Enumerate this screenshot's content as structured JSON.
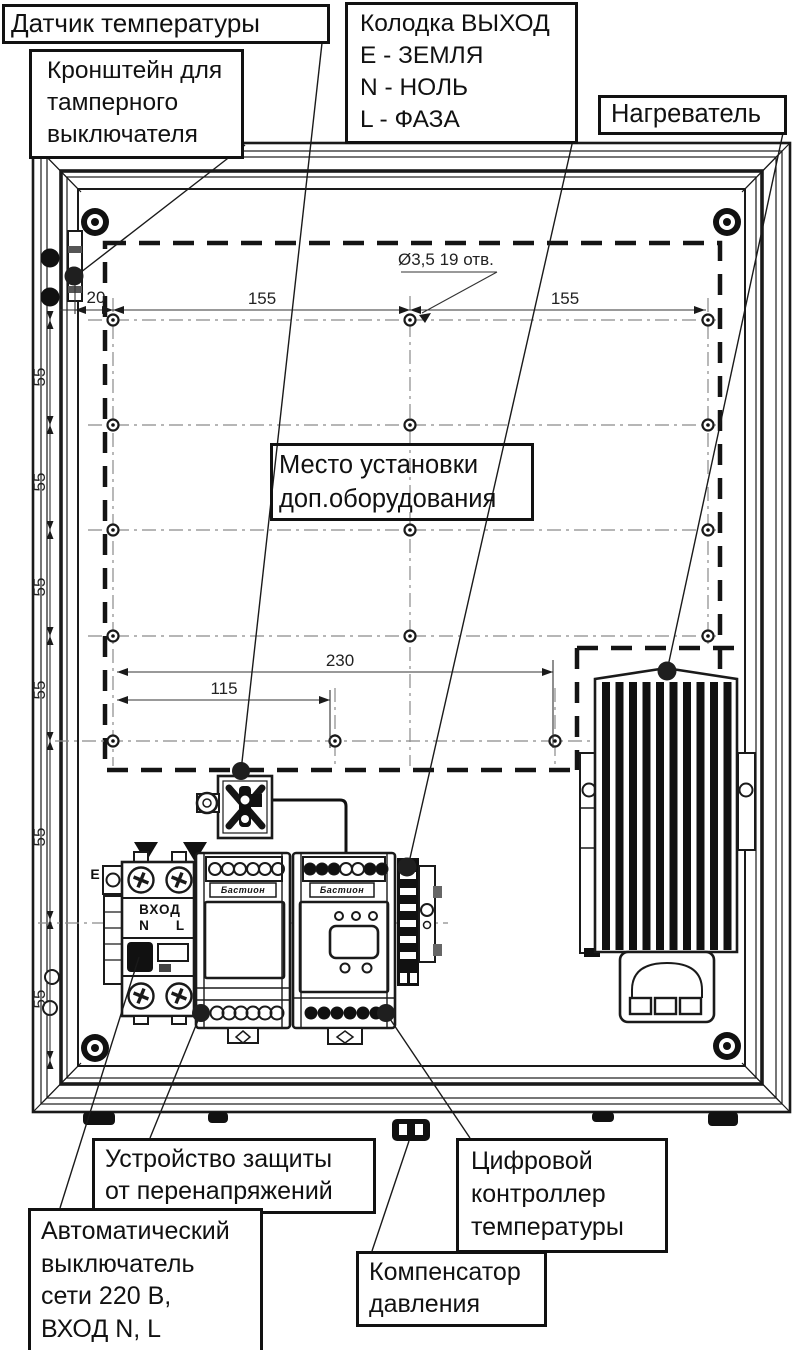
{
  "drawing": {
    "title": "Схема внутреннего монтажа шкафа (вид спереди)",
    "callouts": {
      "temp_sensor": {
        "text": "Датчик температуры"
      },
      "tamper_bracket": {
        "text": "Кронштейн для\nтамперного\nвыключателя"
      },
      "output_block": {
        "text": "Колодка ВЫХОД\nE - ЗЕМЛЯ\nN - НОЛЬ\nL - ФАЗА"
      },
      "heater": {
        "text": "Нагреватель"
      },
      "equipment_area": {
        "text": "Место установки\nдоп.оборудования"
      },
      "surge_protector": {
        "text": "Устройство защиты\nот перенапряжений"
      },
      "breaker": {
        "text": "Автоматический\nвыключатель\nсети 220 В,\nВХОД N, L"
      },
      "controller": {
        "text": "Цифровой\nконтроллер\nтемпературы"
      },
      "compensator": {
        "text": "Компенсатор\nдавления"
      }
    },
    "dimensions": {
      "hole_note": "Ø3,5 19 отв.",
      "d20": "20",
      "d155_left": "155",
      "d155_right": "155",
      "d230": "230",
      "d115": "115",
      "left_chain": [
        "55",
        "55",
        "55",
        "55",
        "55",
        "55"
      ]
    },
    "markings": {
      "input_label": "ВХОД",
      "n": "N",
      "l": "L",
      "earth": "E",
      "brand": "Бастион"
    },
    "colors": {
      "line": "#1a1a1a",
      "background": "#ffffff",
      "centerline": "#8a8a8a"
    }
  }
}
